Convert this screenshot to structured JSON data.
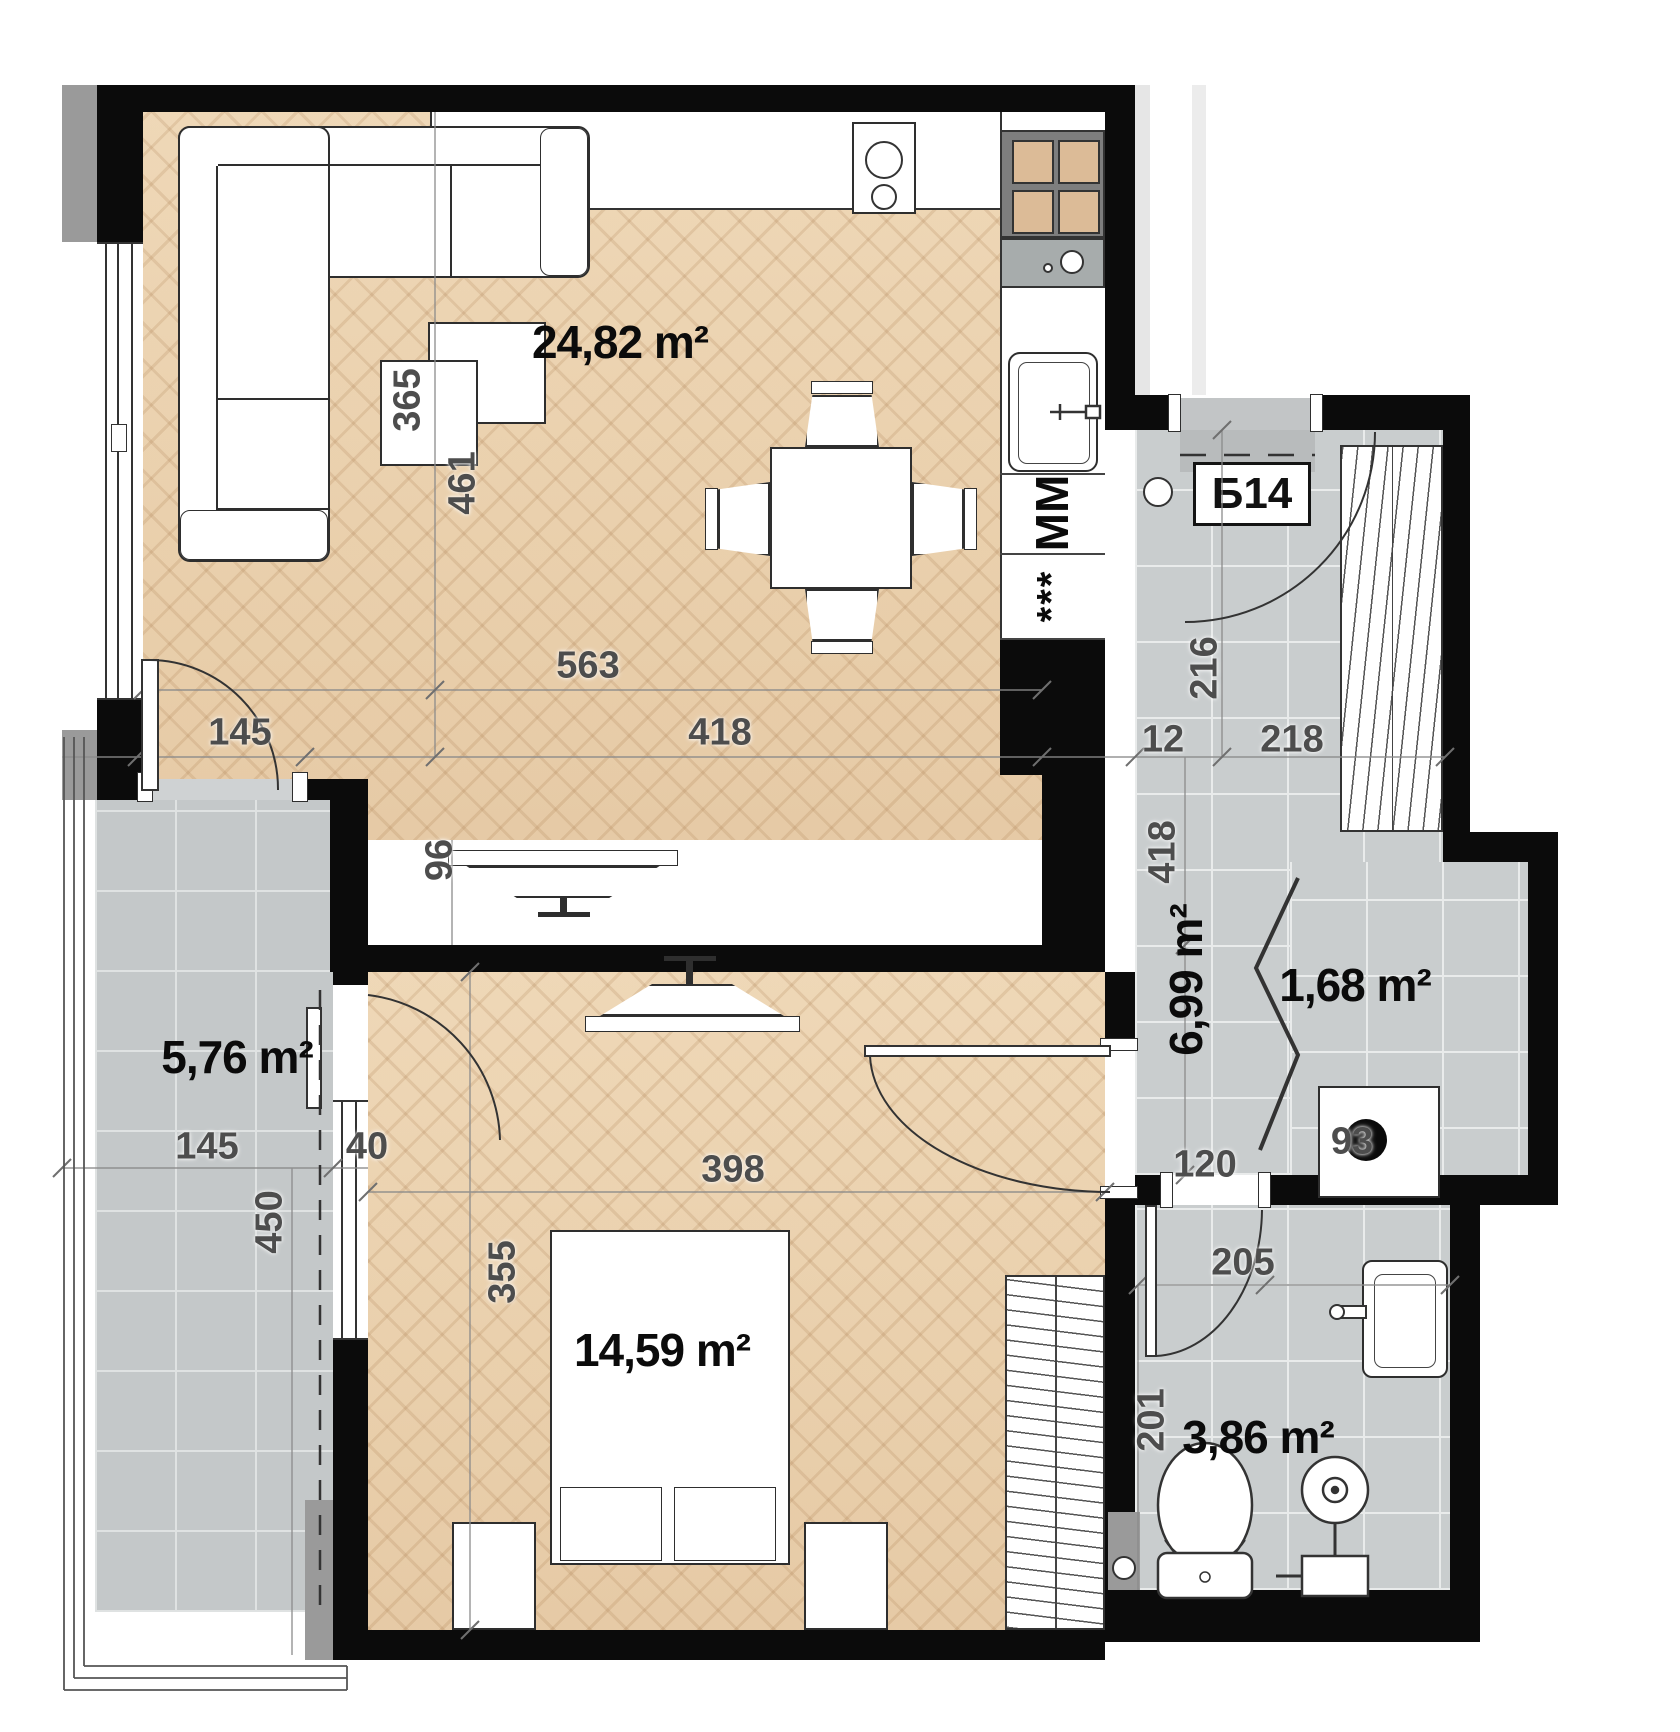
{
  "plan": {
    "unit_label": "Б14",
    "areas": [
      {
        "room": "living-kitchen",
        "label": "24,82 m²",
        "x": 620,
        "y": 342,
        "vertical": false
      },
      {
        "room": "bedroom",
        "label": "14,59 m²",
        "x": 662,
        "y": 1350,
        "vertical": false
      },
      {
        "room": "balcony",
        "label": "5,76 m²",
        "x": 237,
        "y": 1057,
        "vertical": false
      },
      {
        "room": "hallway",
        "label": "6,99 m²",
        "x": 1186,
        "y": 980,
        "vertical": true
      },
      {
        "room": "closet",
        "label": "1,68 m²",
        "x": 1355,
        "y": 985,
        "vertical": false
      },
      {
        "room": "bathroom",
        "label": "3,86 m²",
        "x": 1258,
        "y": 1437,
        "vertical": false
      }
    ],
    "dimensions": [
      {
        "label": "365",
        "x": 408,
        "y": 400,
        "vertical": true
      },
      {
        "label": "461",
        "x": 463,
        "y": 483,
        "vertical": true
      },
      {
        "label": "563",
        "x": 588,
        "y": 666,
        "vertical": false
      },
      {
        "label": "418",
        "x": 720,
        "y": 733,
        "vertical": false
      },
      {
        "label": "145",
        "x": 240,
        "y": 733,
        "vertical": false
      },
      {
        "label": "96",
        "x": 440,
        "y": 860,
        "vertical": true
      },
      {
        "label": "216",
        "x": 1205,
        "y": 668,
        "vertical": true
      },
      {
        "label": "12",
        "x": 1163,
        "y": 740,
        "vertical": false
      },
      {
        "label": "218",
        "x": 1292,
        "y": 740,
        "vertical": false
      },
      {
        "label": "418",
        "x": 1163,
        "y": 852,
        "vertical": true
      },
      {
        "label": "120",
        "x": 1205,
        "y": 1165,
        "vertical": false
      },
      {
        "label": "93",
        "x": 1352,
        "y": 1142,
        "vertical": false
      },
      {
        "label": "205",
        "x": 1243,
        "y": 1263,
        "vertical": false
      },
      {
        "label": "201",
        "x": 1152,
        "y": 1420,
        "vertical": true
      },
      {
        "label": "398",
        "x": 733,
        "y": 1170,
        "vertical": false
      },
      {
        "label": "355",
        "x": 503,
        "y": 1272,
        "vertical": true
      },
      {
        "label": "145",
        "x": 207,
        "y": 1147,
        "vertical": false
      },
      {
        "label": "40",
        "x": 367,
        "y": 1147,
        "vertical": false
      },
      {
        "label": "450",
        "x": 270,
        "y": 1222,
        "vertical": true
      }
    ],
    "kitchen": {
      "microwave_label": "MM",
      "dishwasher_label": "***"
    },
    "colors": {
      "wall": "#0b0b0b",
      "wood": "#e9d0ae",
      "tile": "#c9cdce",
      "parapet": "#9a9a9a"
    }
  }
}
